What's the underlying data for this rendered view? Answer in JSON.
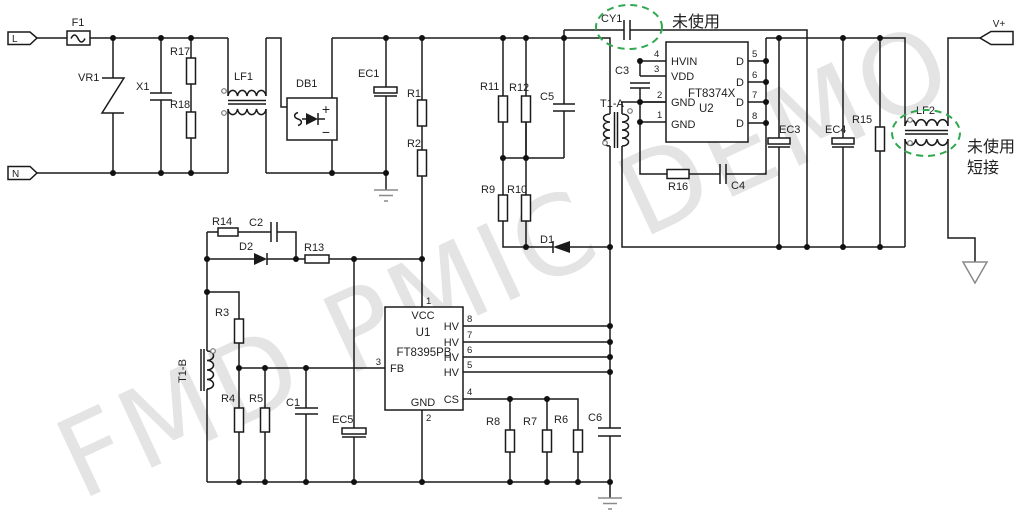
{
  "watermark": "FMD PMIC DEMO",
  "colors": {
    "wire": "#1a1a1a",
    "annotation_green": "#2fa84f",
    "watermark_gray": "#e4e4e4",
    "ground_gray": "#8a8a8a"
  },
  "terminals": {
    "live": "L",
    "neutral": "N",
    "vout": "V+"
  },
  "notes": {
    "cy1": "未使用",
    "lf2_line1": "未使用",
    "lf2_line2": "短接"
  },
  "components": {
    "f1": "F1",
    "vr1": "VR1",
    "x1": "X1",
    "r17": "R17",
    "r18": "R18",
    "lf1": "LF1",
    "db1": "DB1",
    "db1_plus": "+",
    "db1_minus": "−",
    "ec1": "EC1",
    "r1": "R1",
    "r2": "R2",
    "r11": "R11",
    "r12": "R12",
    "c5": "C5",
    "r9": "R9",
    "r10": "R10",
    "d1": "D1",
    "cy1": "CY1",
    "t1a": "T1-A",
    "c3": "C3",
    "r16": "R16",
    "c4": "C4",
    "ec3": "EC3",
    "ec4": "EC4",
    "r15": "R15",
    "lf2": "LF2",
    "r14": "R14",
    "c2": "C2",
    "d2": "D2",
    "r13": "R13",
    "r3": "R3",
    "t1b": "T1-B",
    "r4": "R4",
    "r5": "R5",
    "c1": "C1",
    "ec5": "EC5",
    "r8": "R8",
    "r7": "R7",
    "r6": "R6",
    "c6": "C6"
  },
  "u1": {
    "ref": "U1",
    "part": "FT8395PB",
    "pin_vcc": "VCC",
    "pin_fb": "FB",
    "pin_gnd": "GND",
    "pin_cs": "CS",
    "pin_hv": "HV",
    "num_vcc": "1",
    "num_gnd": "2",
    "num_fb": "3",
    "num_cs": "4",
    "hv_nums": [
      "8",
      "7",
      "6",
      "5"
    ]
  },
  "u2": {
    "ref": "U2",
    "part": "FT8374X",
    "pin_hvin": "HVIN",
    "pin_vdd": "VDD",
    "pin_gnd2": "GND",
    "pin_gnd1": "GND",
    "pin_d": "D",
    "left_nums": [
      "4",
      "3",
      "2",
      "1"
    ],
    "right_nums": [
      "5",
      "6",
      "7",
      "8"
    ]
  }
}
